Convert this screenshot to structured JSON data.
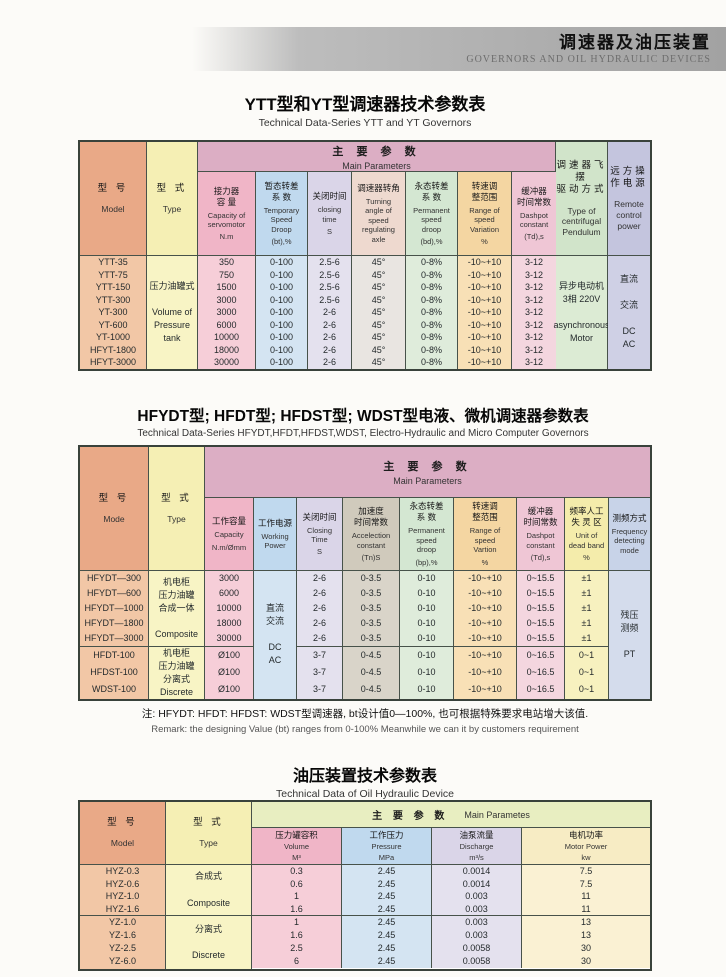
{
  "colors": {
    "band_pink": "#dcaec4",
    "band_green": "#e8eec1",
    "model_salmon": "#e9a987",
    "type_yellow": "#f5efb4",
    "banner_gray": "#a2a2a2",
    "border": "#47524a"
  },
  "banner": {
    "title_cn": "调速器及油压装置",
    "title_en": "GOVERNORS AND OIL HYDRAULIC DEVICES"
  },
  "t1": {
    "title_cn": "YTT型和YT型调速器技术参数表",
    "title_en": "Technical Data-Series YTT and YT Governors",
    "band_cn": "主 要 参 数",
    "band_en": "Main Parameters",
    "h": {
      "model_cn": "型  号",
      "model_en": "Model",
      "type_cn": "型  式",
      "type_en": "Type",
      "cap_cn": "接力器\n容  量",
      "cap_en": "Capacity of\nservomotor",
      "cap_u": "N.m",
      "bt_cn": "暂态转差\n系  数",
      "bt_en": "Temporary\nSpeed\nDroop",
      "bt_u": "(bt),%",
      "cls_cn": "关闭时间",
      "cls_en": "closing\ntime",
      "cls_u": "S",
      "ang_cn": "调速器转角",
      "ang_en": "Turning\nangle of\nspeed\nregulating\naxle",
      "bd_cn": "永态转差\n系  数",
      "bd_en": "Permanent\nspeed\ndroop",
      "bd_u": "(bd),%",
      "rng_cn": "转速调\n整范围",
      "rng_en": "Range of\nspeed\nVariation",
      "rng_u": "%",
      "td_cn": "缓冲器\n时间常数",
      "td_en": "Dashpot\nconstant",
      "td_u": "(Td),s",
      "pend_cn": "调速器飞摆\n驱动方式",
      "pend_en": "Type of\ncentrifugal\nPendulum",
      "rem_cn": "远方操\n作电源",
      "rem_en": "Remote\ncontrol\npower"
    },
    "model": [
      "YTT-35",
      "YTT-75",
      "YTT-150",
      "YTT-300",
      "YT-300",
      "YT-600",
      "YT-1000",
      "HFYT-1800",
      "HFYT-3000"
    ],
    "type_merged": "压力油罐式\n\nVolume of\nPressure\ntank",
    "cap": [
      "350",
      "750",
      "1500",
      "3000",
      "3000",
      "6000",
      "10000",
      "18000",
      "30000"
    ],
    "bt": [
      "0-100",
      "0-100",
      "0-100",
      "0-100",
      "0-100",
      "0-100",
      "0-100",
      "0-100",
      "0-100"
    ],
    "cls": [
      "2.5-6",
      "2.5-6",
      "2.5-6",
      "2.5-6",
      "2-6",
      "2-6",
      "2-6",
      "2-6",
      "2-6"
    ],
    "ang": [
      "45°",
      "45°",
      "45°",
      "45°",
      "45°",
      "45°",
      "45°",
      "45°",
      "45°"
    ],
    "bd": [
      "0-8%",
      "0-8%",
      "0-8%",
      "0-8%",
      "0-8%",
      "0-8%",
      "0-8%",
      "0-8%",
      "0-8%"
    ],
    "rng": [
      "-10~+10",
      "-10~+10",
      "-10~+10",
      "-10~+10",
      "-10~+10",
      "-10~+10",
      "-10~+10",
      "-10~+10",
      "-10~+10"
    ],
    "td": [
      "3-12",
      "3-12",
      "3-12",
      "3-12",
      "3-12",
      "3-12",
      "3-12",
      "3-12",
      "3-12"
    ],
    "pend_merged": "异步电动机\n3相 220V\n\nasynchronous\nMotor",
    "rem_merged": "直流\n\n交流\n\nDC\nAC"
  },
  "t2": {
    "title_cn": "HFYDT型; HFDT型; HFDST型; WDST型电液、微机调速器参数表",
    "title_en": "Technical Data-Series HFYDT,HFDT,HFDST,WDST, Electro-Hydraulic and Micro Computer Governors",
    "band_cn": "主 要 参 数",
    "band_en": "Main Parameters",
    "h": {
      "model_cn": "型  号",
      "model_en": "Mode",
      "type_cn": "型  式",
      "type_en": "Type",
      "cap_cn": "工作容量",
      "cap_en": "Capacity",
      "cap_u": "N.m/Ømm",
      "pwr_cn": "工作电源",
      "pwr_en": "Working\nPower",
      "cls_cn": "关闭时间",
      "cls_en": "Closing\nTime",
      "cls_u": "S",
      "tn_cn": "加速度\n时间常数",
      "tn_en": "Accelection\nconstant",
      "tn_u": "(Tn)S",
      "bp_cn": "永态转差\n系  数",
      "bp_en": "Permanent\nspeed\ndroop",
      "bp_u": "(bp),%",
      "rng_cn": "转速调\n整范围",
      "rng_en": "Range of\nspeed\nVartion",
      "rng_u": "%",
      "td_cn": "缓冲器\n时间常数",
      "td_en": "Dashpot\nconstant",
      "td_u": "(Td),s",
      "db_cn": "频率人工\n失 灵 区",
      "db_en": "Unit of\ndead band",
      "db_u": "%",
      "mode_cn": "测频方式",
      "mode_en": "Frequency\ndetecting\nmode"
    },
    "model_g1": [
      "HFYDT—300",
      "HFYDT—600",
      "HFYDT—1000",
      "HFYDT—1800",
      "HFYDT—3000"
    ],
    "model_g2": [
      "HFDT-100",
      "HFDST-100",
      "WDST-100"
    ],
    "type_g1": "机电柜\n压力油罐\n合成一体\n\nComposite",
    "type_g2": "机电柜\n压力油罐\n分离式\nDiscrete",
    "cap_g1": [
      "3000",
      "6000",
      "10000",
      "18000",
      "30000"
    ],
    "cap_g2": [
      "Ø100",
      "Ø100",
      "Ø100"
    ],
    "pwr_merged": "直流\n交流\n\nDC\nAC",
    "cls_g1": [
      "2-6",
      "2-6",
      "2-6",
      "2-6",
      "2-6"
    ],
    "cls_g2": [
      "3-7",
      "3-7",
      "3-7"
    ],
    "tn_g1": [
      "0-3.5",
      "0-3.5",
      "0-3.5",
      "0-3.5",
      "0-3.5"
    ],
    "tn_g2": [
      "0-4.5",
      "0-4.5",
      "0-4.5"
    ],
    "bp_g1": [
      "0-10",
      "0-10",
      "0-10",
      "0-10",
      "0-10"
    ],
    "bp_g2": [
      "0-10",
      "0-10",
      "0-10"
    ],
    "rng_g1": [
      "-10~+10",
      "-10~+10",
      "-10~+10",
      "-10~+10",
      "-10~+10"
    ],
    "rng_g2": [
      "-10~+10",
      "-10~+10",
      "-10~+10"
    ],
    "td_g1": [
      "0~15.5",
      "0~15.5",
      "0~15.5",
      "0~15.5",
      "0~15.5"
    ],
    "td_g2": [
      "0~16.5",
      "0~16.5",
      "0~16.5"
    ],
    "db_g1": [
      "±1",
      "±1",
      "±1",
      "±1",
      "±1"
    ],
    "db_g2": [
      "0~1",
      "0~1",
      "0~1"
    ],
    "mode_merged": "残压\n测频\n\nPT",
    "note_cn": "注: HFYDT: HFDT: HFDST: WDST型调速器, bt设计值0—100%, 也可根据特殊要求电站增大该值.",
    "note_en": "Remark: the designing Value (bt) ranges from 0-100% Meanwhile we can it by customers requirement"
  },
  "t3": {
    "title_cn": "油压装置技术参数表",
    "title_en": "Technical Data of Oil Hydraulic Device",
    "band_cn": "主 要 参 数",
    "band_en": "Main Parametes",
    "h": {
      "model_cn": "型  号",
      "model_en": "Model",
      "type_cn": "型  式",
      "type_en": "Type",
      "vol_cn": "压力罐容积",
      "vol_en": "Volume",
      "vol_u": "M³",
      "prs_cn": "工作压力",
      "prs_en": "Pressure",
      "prs_u": "MPa",
      "dis_cn": "油泵流量",
      "dis_en": "Discharge",
      "dis_u": "m³/s",
      "mot_cn": "电机功率",
      "mot_en": "Motor  Power",
      "mot_u": "kw"
    },
    "model_g1": [
      "HYZ-0.3",
      "HYZ-0.6",
      "HYZ-1.0",
      "HYZ-1.6"
    ],
    "model_g2": [
      "YZ-1.0",
      "YZ-1.6",
      "YZ-2.5",
      "YZ-6.0"
    ],
    "type_g1": "合成式\n\nComposite",
    "type_g2": "分离式\n\nDiscrete",
    "vol_g1": [
      "0.3",
      "0.6",
      "1",
      "1.6"
    ],
    "vol_g2": [
      "1",
      "1.6",
      "2.5",
      "6"
    ],
    "prs_g1": [
      "2.45",
      "2.45",
      "2.45",
      "2.45"
    ],
    "prs_g2": [
      "2.45",
      "2.45",
      "2.45",
      "2.45"
    ],
    "dis_g1": [
      "0.0014",
      "0.0014",
      "0.003",
      "0.003"
    ],
    "dis_g2": [
      "0.003",
      "0.003",
      "0.0058",
      "0.0058"
    ],
    "mot_g1": [
      "7.5",
      "7.5",
      "11",
      "11"
    ],
    "mot_g2": [
      "13",
      "13",
      "30",
      "30"
    ]
  }
}
